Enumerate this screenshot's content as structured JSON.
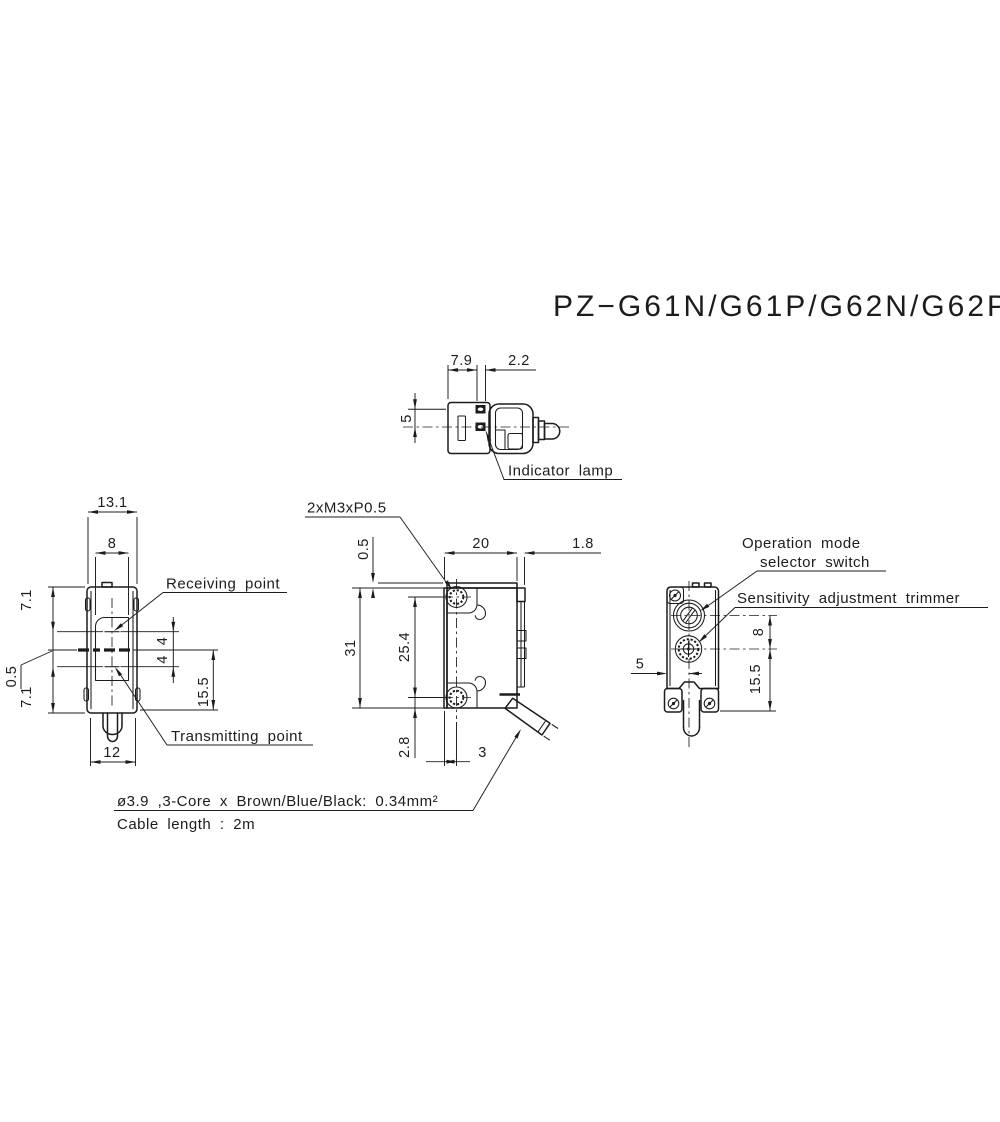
{
  "title": "PZ−G61N/G61P/G62N/G62P",
  "views": {
    "top": {
      "dim_body_to_lamp": "7.9",
      "dim_lamp_width": "2.2",
      "dim_lamp_pitch": "5",
      "label_indicator_lamp": "Indicator lamp"
    },
    "front": {
      "dim_overall_width": "13.1",
      "dim_lens_width": "8",
      "dim_top_to_receiver": "7.1",
      "dim_axis_offset": "0.5",
      "dim_transmitter_to_bottom": "7.1",
      "dim_bottom_width": "12",
      "dim_receiver_to_axis": "4",
      "dim_axis_to_transmitter": "4",
      "dim_axis_to_mount": "15.5",
      "label_receiving": "Receiving point",
      "label_transmitting": "Transmitting point"
    },
    "side": {
      "label_screw": "2xM3xP0.5",
      "dim_lip": "0.5",
      "dim_depth": "20",
      "dim_cover": "1.8",
      "dim_height": "31",
      "dim_hole_pitch": "25.4",
      "dim_hole_to_bottom": "2.8",
      "dim_face_to_hole": "3"
    },
    "rear": {
      "label_mode_line1": "Operation mode",
      "label_mode_line2": "selector switch",
      "label_sensitivity": "Sensitivity adjustment trimmer",
      "dim_edge_to_center": "5",
      "dim_selector_to_trimmer": "8",
      "dim_trimmer_to_mount": "15.5"
    }
  },
  "notes": {
    "cable_spec": "ø3.9 ,3-Core x Brown/Blue/Black: 0.34mm²",
    "cable_length": "Cable length : 2m"
  },
  "colors": {
    "line": "#1c1c1c",
    "background": "#ffffff"
  }
}
